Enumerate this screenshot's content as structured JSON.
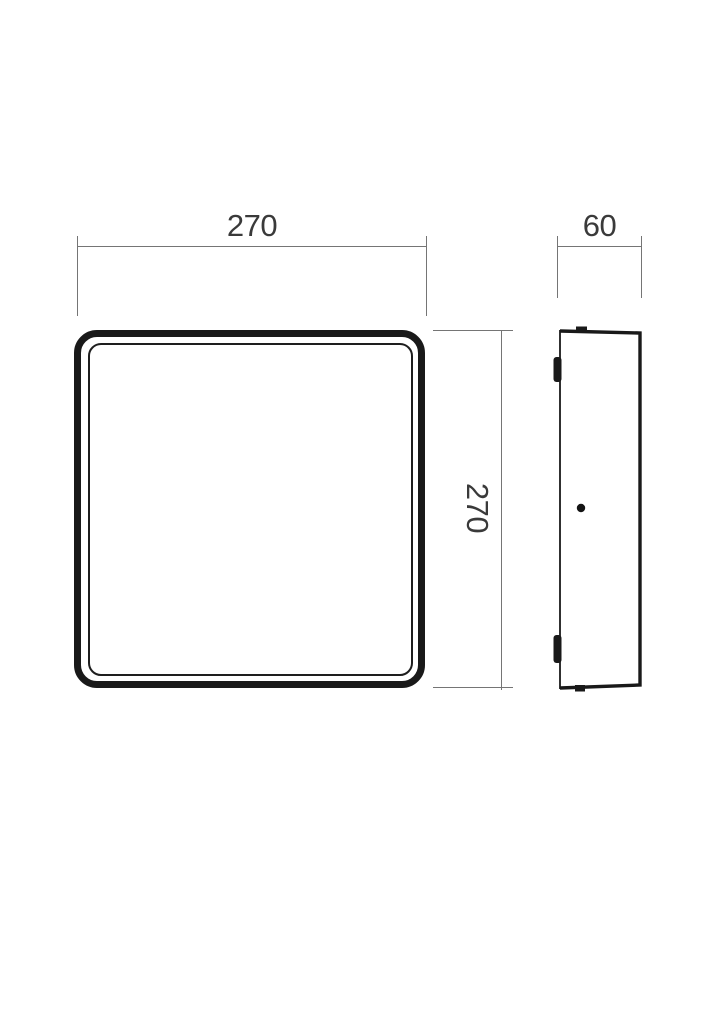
{
  "drawing": {
    "type": "technical-dimension-drawing",
    "views": {
      "front": {
        "shape": "rounded-square"
      },
      "side": {
        "shape": "thin-profile"
      }
    },
    "dimensions": {
      "front_width": {
        "value": "270"
      },
      "front_height": {
        "value": "270"
      },
      "side_depth": {
        "value": "60"
      }
    },
    "colors": {
      "outline": "#191919",
      "dimension_line": "#757575",
      "dimension_text": "#3a3a3a",
      "background": "#ffffff"
    }
  }
}
